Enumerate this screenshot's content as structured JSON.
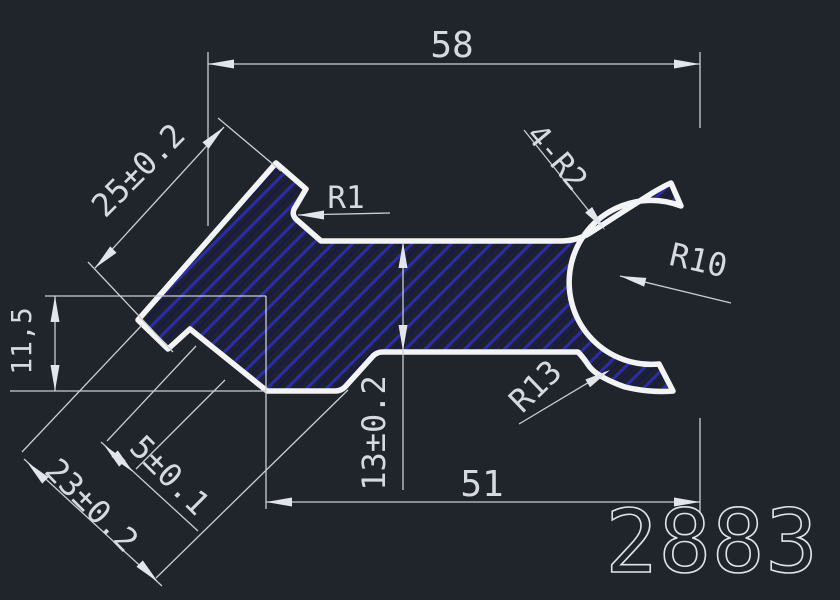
{
  "drawing": {
    "part_number": "2883",
    "dimensions": {
      "overall_width_top": "58",
      "overall_width_bottom": "51",
      "bar_thickness": "13±0.2",
      "arm_length": "25±0.2",
      "foot_height": "11,5",
      "notch_step": "5±0.1",
      "foot_length": "23±0.2"
    },
    "radius_labels": {
      "notch_fillet": "R1",
      "prong_fillets": "4-R2",
      "fork_inner_radius": "R10",
      "fork_outer_radius": "R13"
    },
    "colors": {
      "background": "#20242b",
      "outline": "#f2f4f6",
      "hatch_line": "#2b2bac",
      "hatch_line_faint": "#15155e",
      "dimension_line": "#c9ced4",
      "text": "#d6dade"
    }
  }
}
